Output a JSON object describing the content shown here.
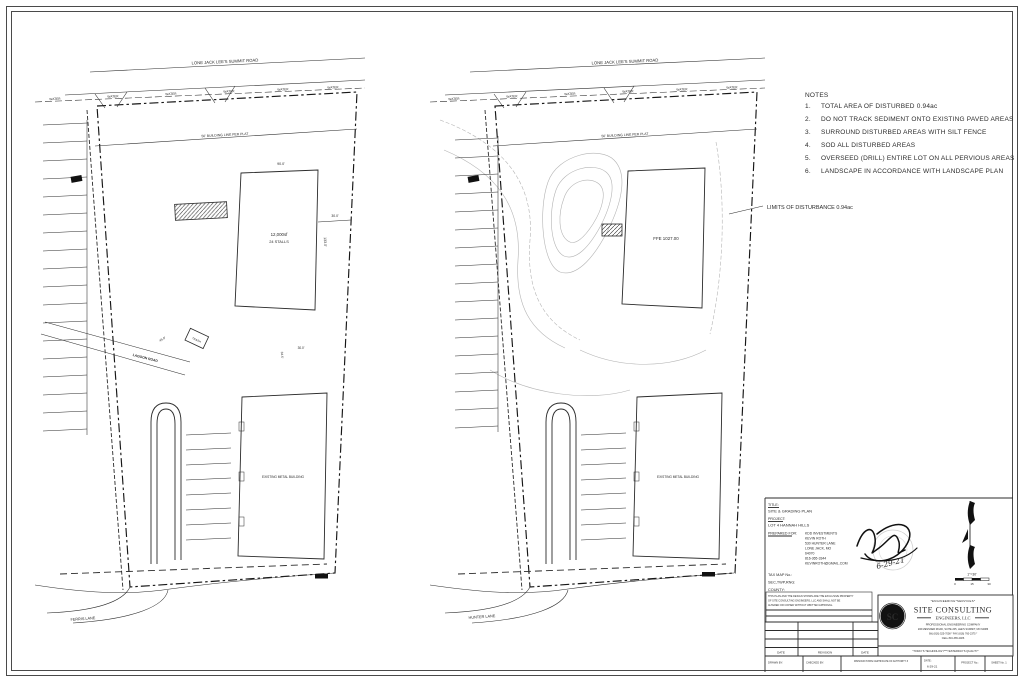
{
  "sheet": {
    "background": "#ffffff",
    "line_color": "#2b2b2b",
    "contour_color": "#b4b4b4"
  },
  "notes": {
    "heading": "NOTES",
    "items": [
      {
        "num": "1.",
        "text": "TOTAL AREA OF DISTURBED 0.94ac"
      },
      {
        "num": "2.",
        "text": "DO NOT TRACK SEDIMENT ONTO EXISTING PAVED AREAS"
      },
      {
        "num": "3.",
        "text": "SURROUND DISTURBED AREAS WITH SILT FENCE"
      },
      {
        "num": "4.",
        "text": "SOD ALL DISTURBED AREAS"
      },
      {
        "num": "5.",
        "text": "OVERSEED (DRILL) ENTIRE LOT ON ALL PERVIOUS AREAS"
      },
      {
        "num": "6.",
        "text": "LANDSCAPE IN ACCORDANCE WITH LANDSCAPE PLAN"
      }
    ]
  },
  "callouts": {
    "limits_of_disturbance": "LIMITS OF DISTURBANCE 0.94ac"
  },
  "plans": {
    "left": {
      "road_label": "LONE JACK LEE'S SUMMIT ROAD",
      "water_label": "WATER",
      "building_line_label": "50' BUILDING LINE PER PLAT",
      "building_area": "12,000sf",
      "building_stalls": "24 STALLS",
      "dim_width": "90.0'",
      "dim_depth": "133.0'",
      "dim_offset": "30.0'",
      "dim_drive": "45.0'",
      "dim_side": "34.5'",
      "dim_rear": "30.0'",
      "trash_label": "TRASH",
      "lagoon_label": "LAGOON ROAD",
      "lower_building_label": "EXISTING METAL BUILDING",
      "street_label": "FERRIS LANE"
    },
    "right": {
      "road_label": "LONE JACK LEE'S SUMMIT ROAD",
      "water_label": "WATER",
      "building_line_label": "50' BUILDING LINE PER PLAT",
      "ffe_label": "FFE 1027.00",
      "lower_building_label": "EXISTING METAL BUILDING",
      "street_label": "HUNTER LANE"
    }
  },
  "title_block": {
    "title_label": "TITLE:",
    "title_value": "SITE & GRADING PLAN",
    "project_label": "PROJECT:",
    "project_value": "LOT 4 HANNAH HILLS",
    "prepared_for_label": "PREPARED FOR:",
    "prepared_for": [
      "KDD INVESTMENTS",
      "KEVIN ROTH",
      "530 HUNTER LANE",
      "LONE JACK, MO",
      "64070",
      "816-365-3344",
      "KEVINROTH@GMAIL.COM"
    ],
    "tax_map_label": "TAX MAP No.:",
    "sec_twp_rng_label": "SEC,TWP,RNG:",
    "county_label": "COUNTY:",
    "signature_date": "6-29-21",
    "scale_text": "1\"=30'",
    "scale_ticks": [
      "0",
      "15",
      "30"
    ],
    "disclaimer": [
      "THIS PLAN AND THE DESIGN SHOWN ARE THE EXCLUSIVE PROPERTY",
      "OF SITE CONSULTING ENGINEERS, LLC AND SHALL NOT BE",
      "ALTERED OR COPIED WITHOUT WRITTEN APPROVAL."
    ],
    "company": {
      "services_line": "*ENGINEERING*SERVICES*",
      "name": "SITE CONSULTING",
      "name_suffix": "ENGINEERS, LLC",
      "subtitle": "PROFESSIONAL ENGINEERING COMPANY",
      "address": "206 MESSNER ROAD, SUITE 205, LEE'S SUMMIT, MO 64086",
      "phone_line": "(W) (816) 525-7008 * FAX (816) 760-2375 *",
      "cell_line": "CELL 816-365-2486",
      "motto": "\"TODAY'S TECHNOLOGY***YESTERDAY'S QUALITY\"",
      "monogram": "SC"
    },
    "revision_table": {
      "col_date": "DATE",
      "col_revision": "REVISION",
      "col_date2": "DATE"
    },
    "bottom_row": {
      "drawn_by": "DRAWN BY:",
      "checked_by": "CHECKED BY:",
      "certificate_line1": "MISSOURI STATE CERTIFICATE OF AUTHORITY #",
      "date_label": "DATE:",
      "date_value": "6-29-21",
      "project_no_label": "PROJECT No.:",
      "sheet_label": "SHEET No. 1"
    }
  }
}
